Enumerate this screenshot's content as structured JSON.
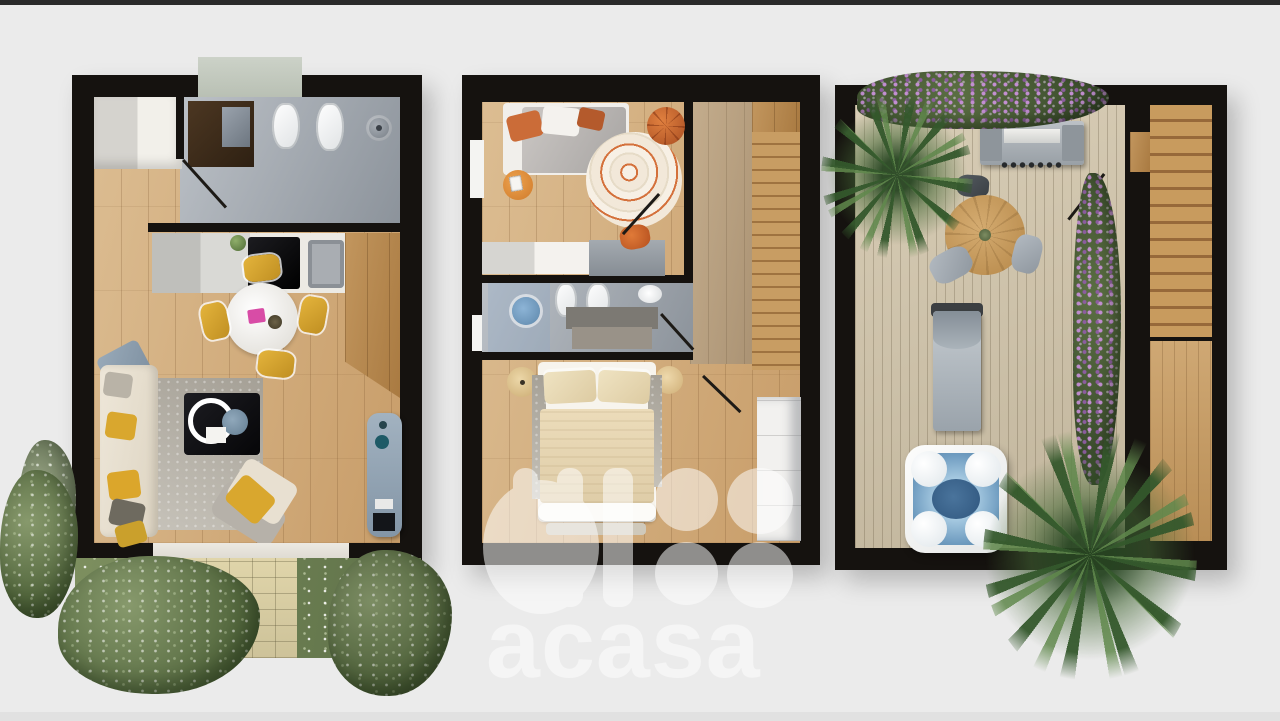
{
  "watermark": {
    "brand": "acasa"
  },
  "colors": {
    "background": "#ebebeb",
    "topbar": "#2a2a2a",
    "wall": "#15120f",
    "wood": "#d3ae7e",
    "wood_dark": "#b3854e",
    "tile_gray": "#a9afb6",
    "deck_wood": "#cfc3ac",
    "grass_green": "#697c50",
    "flower_purple": "#a97cba",
    "accent_yellow": "#d9a72e",
    "accent_orange": "#cc6a35",
    "sofa_cream": "#e9e2d3",
    "steel_gray": "#9fa8b0",
    "water_blue": "#7ba6c9",
    "marble_white": "#eceae4"
  },
  "scene": {
    "type": "3d-floor-plan-rendering",
    "plans": [
      {
        "name": "plan-left",
        "items": [
          "entrance-mat",
          "hall-wardrobe",
          "bathroom",
          "toilet",
          "bidet",
          "shower-head",
          "kitchen-counter",
          "cooktop",
          "kitchen-sink",
          "dining-table",
          "dining-chairs",
          "area-rug",
          "sofa",
          "lounge-chair",
          "coffee-table",
          "armchair",
          "daybed",
          "garden-lawn",
          "paver-path",
          "trees"
        ]
      },
      {
        "name": "plan-middle",
        "items": [
          "bed-with-gray-duvet",
          "round-patterned-rug",
          "pouf",
          "side-table",
          "desk",
          "desk-chair",
          "wardrobe",
          "bathroom",
          "walk-in-shower",
          "toilet",
          "washbasin",
          "double-bed",
          "nightstands",
          "staircase",
          "hallway"
        ]
      },
      {
        "name": "plan-right",
        "items": [
          "flower-hedge",
          "palm-tree",
          "bbq-grill",
          "round-dining-table",
          "stools",
          "planter-hedge",
          "sun-lounger",
          "hot-tub",
          "staircase",
          "roof-deck"
        ]
      }
    ]
  }
}
